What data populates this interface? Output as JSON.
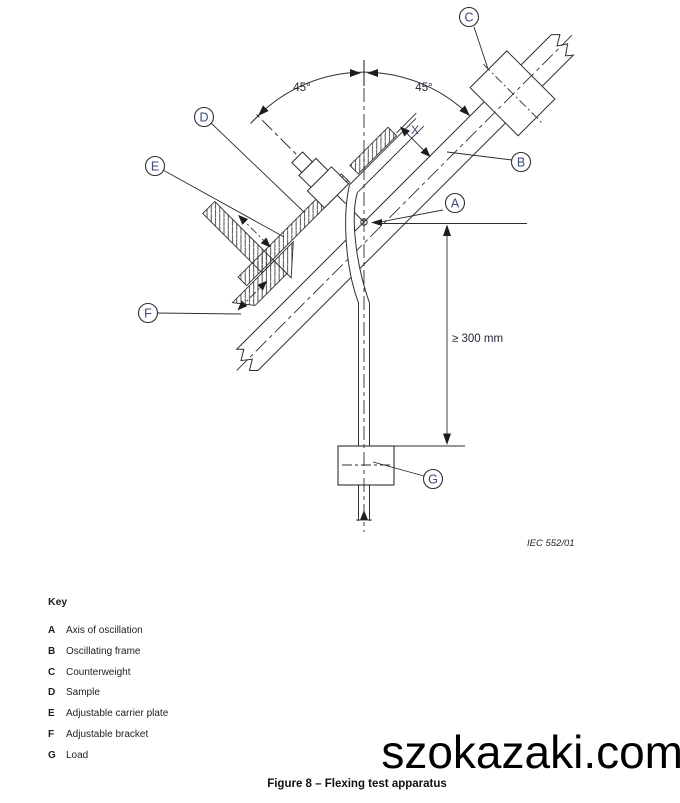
{
  "drawing": {
    "figure_caption": "Figure 8 – Flexing test apparatus",
    "reference": "IEC  552/01",
    "watermark": "szokazaki.com",
    "angle_left": "45°",
    "angle_right": "45°",
    "x_label": "X",
    "min_length_label": "≥ 300 mm",
    "part_labels": {
      "a": "A",
      "b": "B",
      "c": "C",
      "d": "D",
      "e": "E",
      "f": "F",
      "g": "G"
    }
  },
  "key": {
    "title": "Key",
    "items": [
      {
        "letter": "A",
        "label": "Axis of oscillation"
      },
      {
        "letter": "B",
        "label": "Oscillating frame"
      },
      {
        "letter": "C",
        "label": "Counterweight"
      },
      {
        "letter": "D",
        "label": "Sample"
      },
      {
        "letter": "E",
        "label": "Adjustable carrier plate"
      },
      {
        "letter": "F",
        "label": "Adjustable bracket"
      },
      {
        "letter": "G",
        "label": "Load"
      }
    ]
  },
  "colors": {
    "line": "#2e2e2e",
    "label_text": "#3c4a78",
    "body_text": "#1f1f1f"
  }
}
